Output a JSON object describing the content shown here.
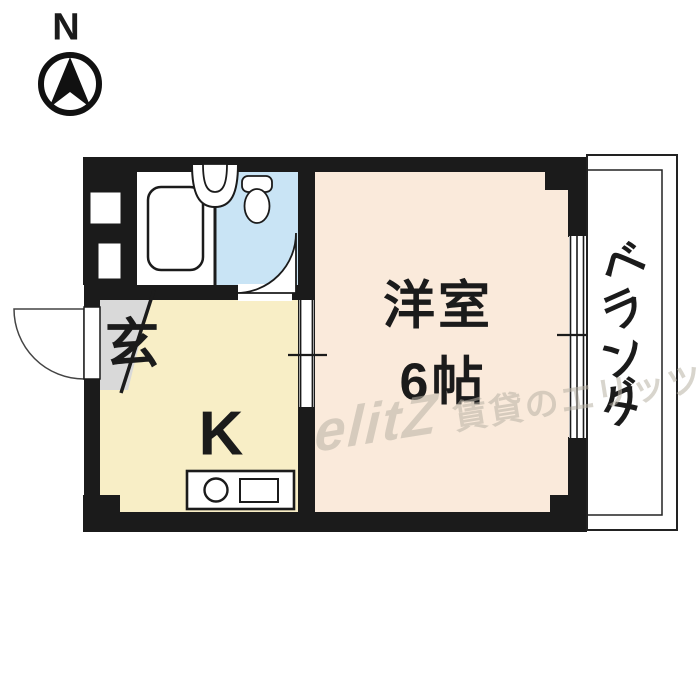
{
  "compass": {
    "north_label": "N"
  },
  "plan": {
    "rooms": {
      "western_room": {
        "line1": "洋室",
        "line2": "6帖"
      },
      "kitchen": {
        "label": "K"
      },
      "genkan": {
        "label": "玄"
      },
      "veranda": {
        "chars": [
          "ベ",
          "ラ",
          "ン",
          "ダ"
        ]
      }
    },
    "colors": {
      "wall": "#1b1b1b",
      "western_room": "#faeadb",
      "kitchen": "#f8eec6",
      "toilet": "#c9e4f5",
      "genkan": "#d9d9d9",
      "bath": "#ffffff"
    }
  },
  "watermark": {
    "logo": "elitZ",
    "text": "賃貸のエリッツ"
  }
}
